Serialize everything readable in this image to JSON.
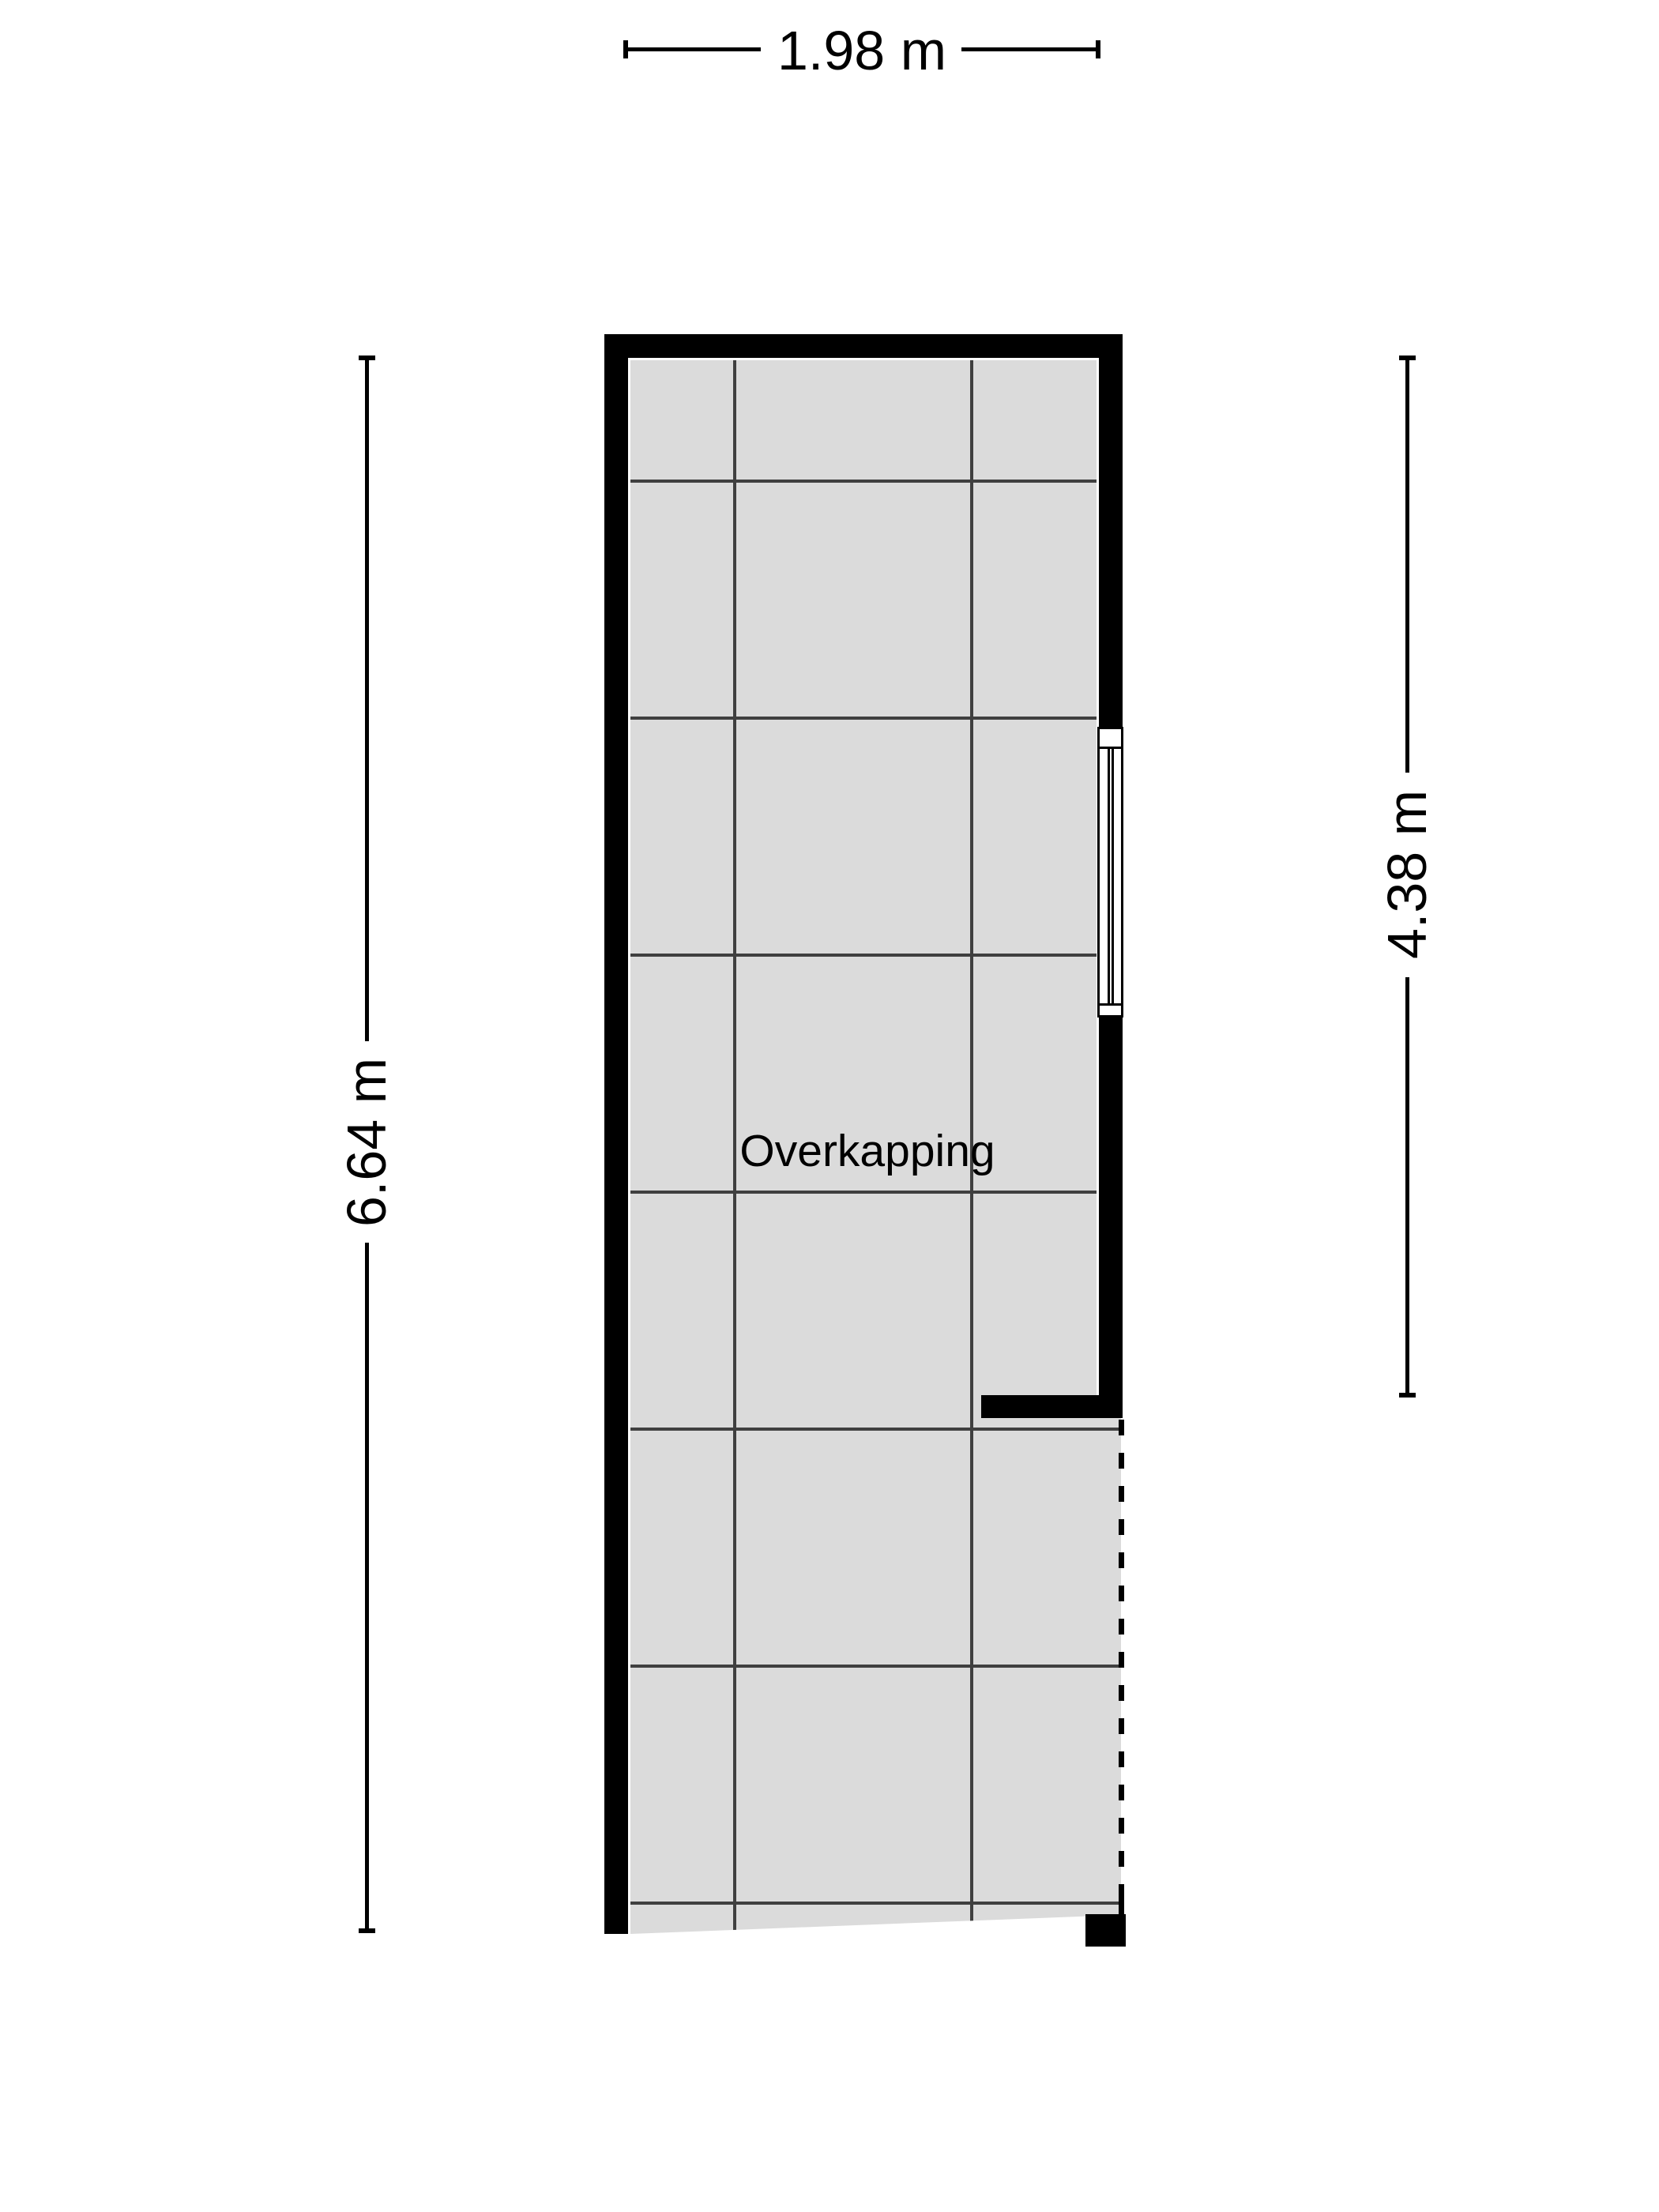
{
  "floorplan": {
    "room_label": "Overkapping",
    "dimensions": {
      "width_top": "1.98 m",
      "height_left": "6.64 m",
      "height_right": "4.38 m"
    },
    "colors": {
      "wall": "#000000",
      "floor": "#dbdbdb",
      "grid": "#3f3f3f",
      "dim": "#000000",
      "bg": "#ffffff"
    }
  }
}
